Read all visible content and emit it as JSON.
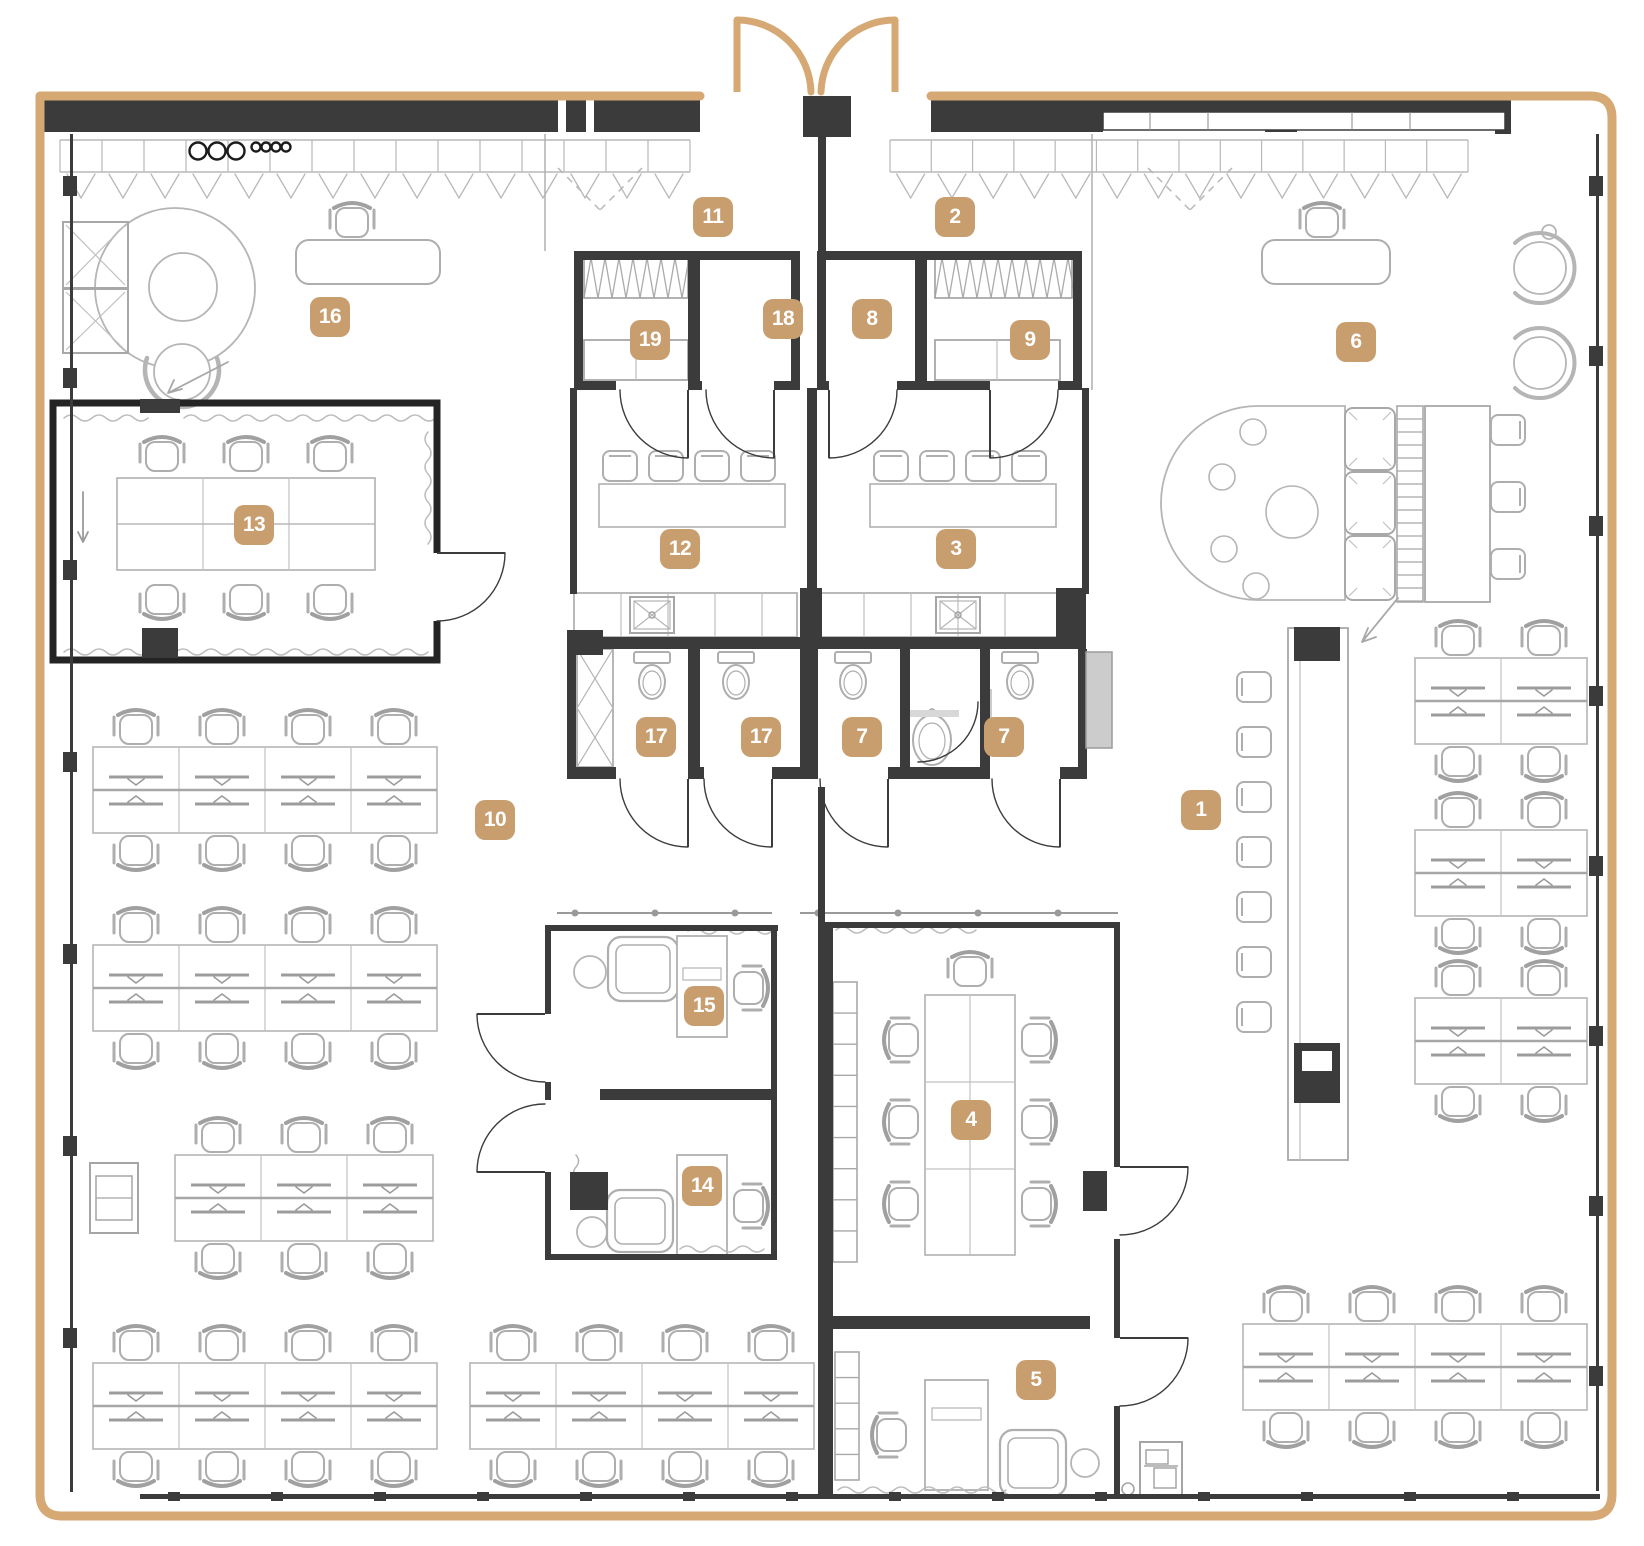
{
  "meta": {
    "kind": "office-floor-plan",
    "width_px": 1644,
    "height_px": 1546
  },
  "colors": {
    "accent": "#c89e6f",
    "label_text": "#ffffff",
    "wall": "#3b3b3b",
    "furniture_line": "#aeaeae",
    "outline_tan": "#d6a873",
    "panel_gray": "#cccccc"
  },
  "room_labels": [
    {
      "number": "1",
      "x": 1201,
      "y": 810
    },
    {
      "number": "2",
      "x": 955,
      "y": 217
    },
    {
      "number": "3",
      "x": 956,
      "y": 549
    },
    {
      "number": "4",
      "x": 971,
      "y": 1120
    },
    {
      "number": "5",
      "x": 1036,
      "y": 1380
    },
    {
      "number": "6",
      "x": 1356,
      "y": 342
    },
    {
      "number": "7",
      "x": 862,
      "y": 737
    },
    {
      "number": "7",
      "x": 1004,
      "y": 737
    },
    {
      "number": "8",
      "x": 872,
      "y": 319
    },
    {
      "number": "9",
      "x": 1030,
      "y": 340
    },
    {
      "number": "10",
      "x": 495,
      "y": 820
    },
    {
      "number": "11",
      "x": 713,
      "y": 217
    },
    {
      "number": "12",
      "x": 680,
      "y": 549
    },
    {
      "number": "13",
      "x": 254,
      "y": 525
    },
    {
      "number": "14",
      "x": 702,
      "y": 1186
    },
    {
      "number": "15",
      "x": 704,
      "y": 1006
    },
    {
      "number": "16",
      "x": 330,
      "y": 317
    },
    {
      "number": "17",
      "x": 656,
      "y": 737
    },
    {
      "number": "17",
      "x": 761,
      "y": 737
    },
    {
      "number": "18",
      "x": 783,
      "y": 319
    },
    {
      "number": "19",
      "x": 650,
      "y": 340
    }
  ]
}
